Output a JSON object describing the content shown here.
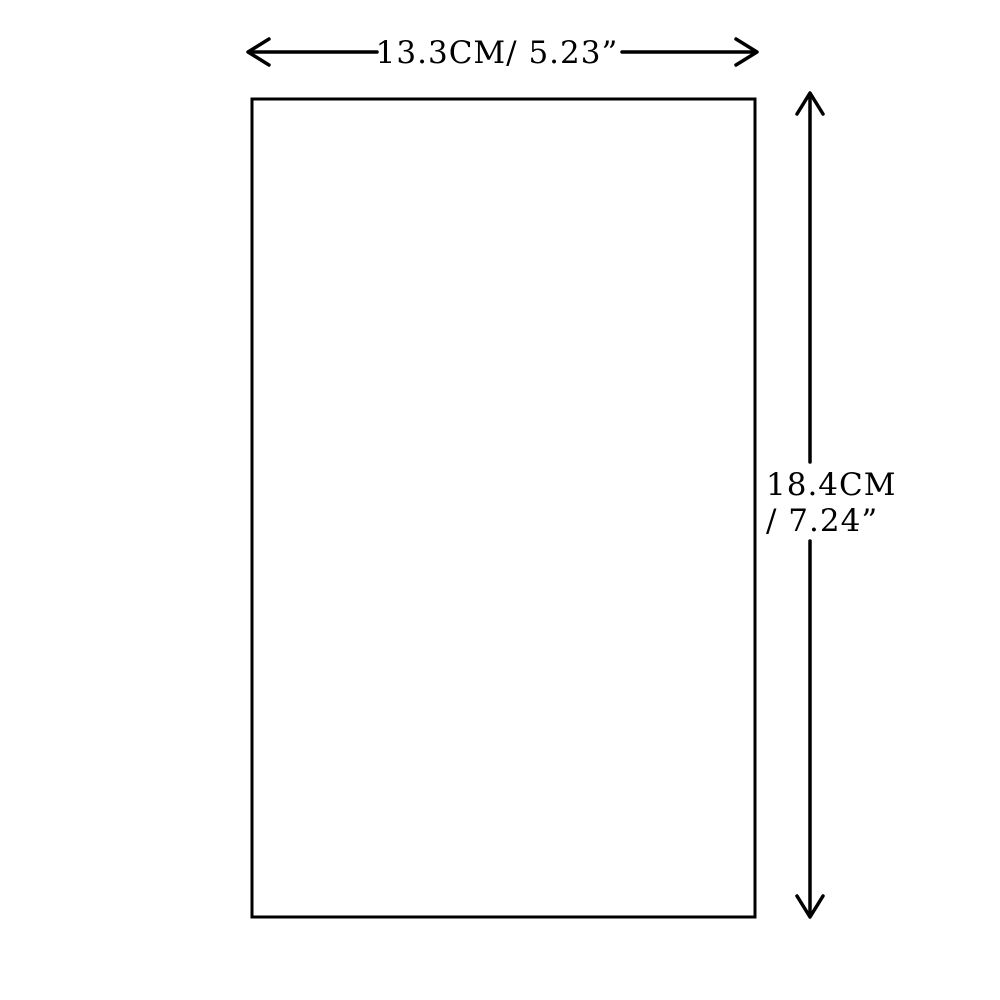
{
  "diagram": {
    "width_label": "13.3CM/ 5.23”",
    "height_label_line1": "18.4CM",
    "height_label_line2": "/ 7.24”",
    "colors": {
      "background": "#ffffff",
      "line": "#000000",
      "rect_fill": "#ffffff"
    }
  }
}
